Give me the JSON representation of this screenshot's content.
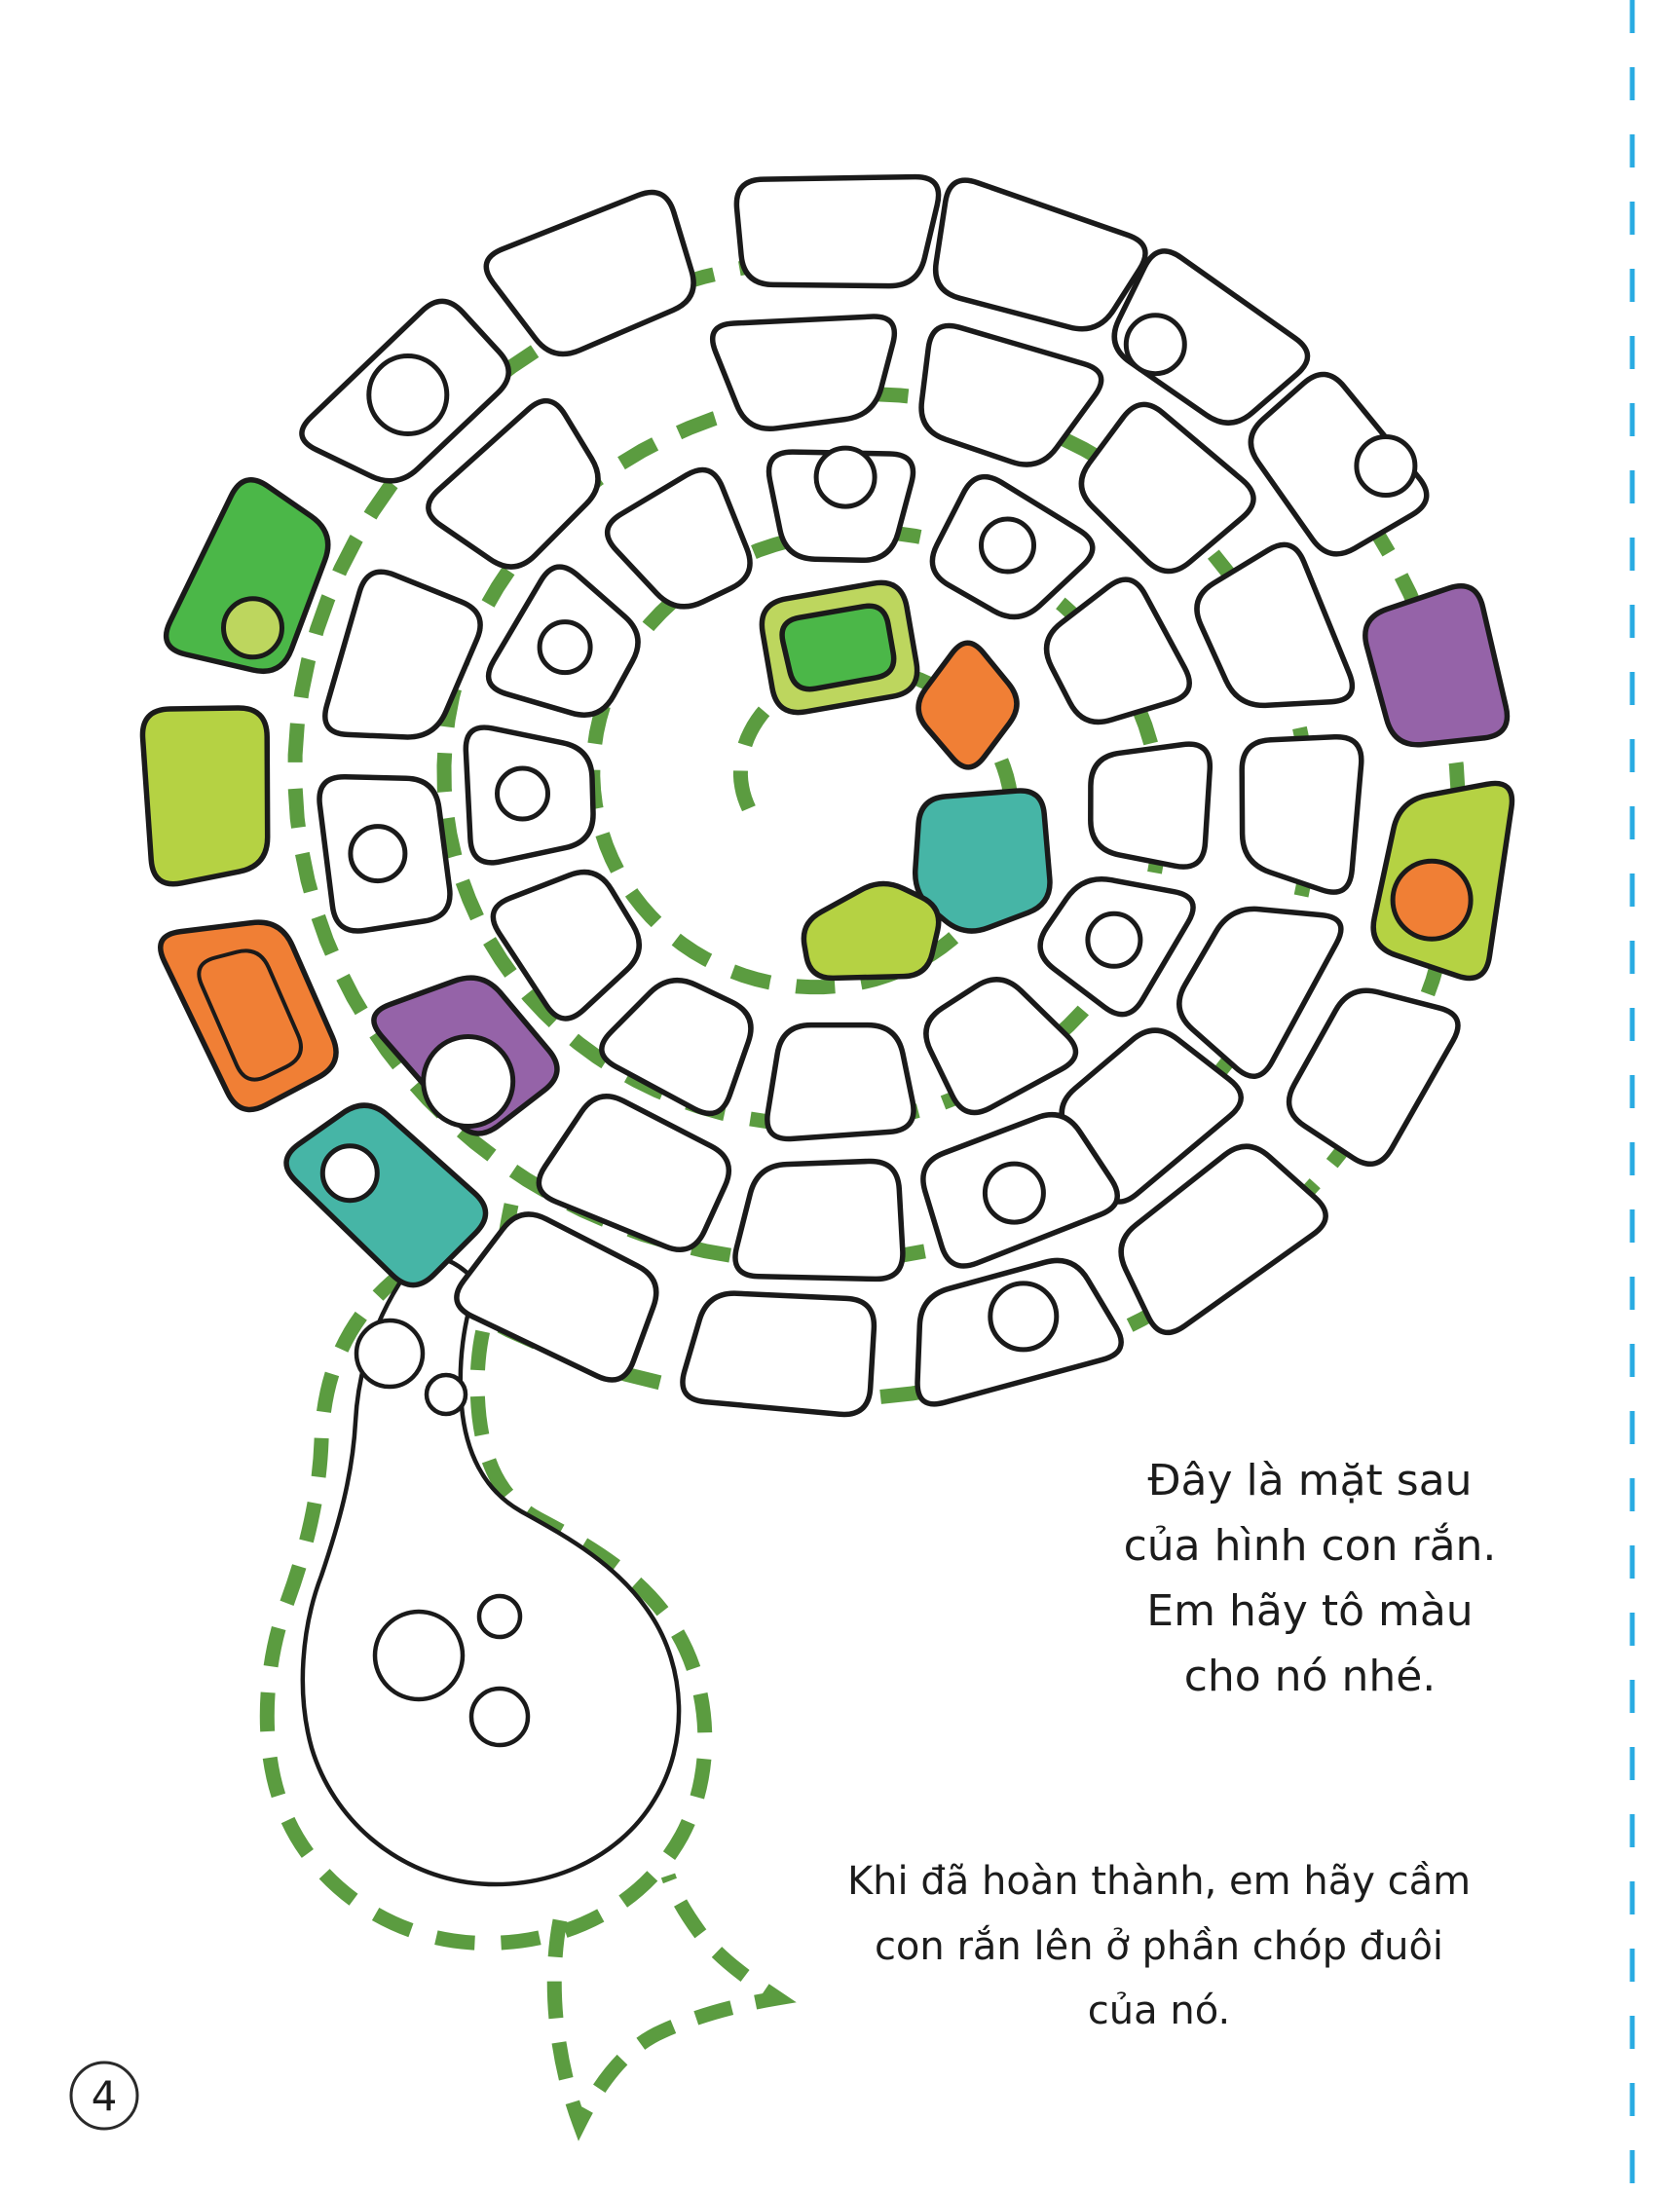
{
  "page": {
    "number": "4"
  },
  "instructions": {
    "block1": {
      "lines": [
        "Đây là mặt sau",
        "của hình con rắn.",
        "Em hãy tô màu",
        "cho nó nhé."
      ]
    },
    "block2": {
      "lines": [
        "Khi đã hoàn thành, em hãy cầm",
        "con rắn lên ở phần chóp đuôi",
        "của nó."
      ]
    }
  },
  "figure": {
    "description": "spiral snake back-side outline for coloring, dashed green cut lines, forked tail at bottom, spotted head bulb",
    "colors": {
      "white": "#ffffff",
      "green": "#4bb748",
      "lime": "#b5d243",
      "lime_light": "#bdd65e",
      "orange": "#f07f35",
      "teal": "#46b5a6",
      "purple": "#9563a8",
      "dash": "#5b9c40",
      "cyan": "#29abe2",
      "outline": "#1a1a1a"
    },
    "rings": {
      "1": {
        "r": [
          250,
          370
        ],
        "span": 23
      },
      "2": {
        "r": [
          396,
          516
        ],
        "span": 20
      },
      "3": {
        "r": [
          542,
          662
        ],
        "span": 17
      }
    },
    "scales": [
      {
        "ring": 3,
        "angle": 270,
        "color": "white"
      },
      {
        "ring": 3,
        "angle": 288,
        "color": "white"
      },
      {
        "ring": 3,
        "angle": 306,
        "color": "white",
        "spot": {
          "r": 30,
          "dr": -35,
          "da": -3
        }
      },
      {
        "ring": 3,
        "angle": 325,
        "color": "white",
        "spot": {
          "r": 30,
          "dr": 35,
          "da": 2
        }
      },
      {
        "ring": 3,
        "angle": 347,
        "color": "purple"
      },
      {
        "ring": 3,
        "angle": 8,
        "color": "lime",
        "spot": {
          "color": "orange",
          "r": 40,
          "dr": -12,
          "da": 3
        }
      },
      {
        "ring": 3,
        "angle": 30,
        "color": "white"
      },
      {
        "ring": 3,
        "angle": 52,
        "color": "white"
      },
      {
        "ring": 3,
        "angle": 74,
        "color": "white",
        "spot": {
          "r": 34,
          "dr": -20,
          "da": -2
        }
      },
      {
        "ring": 3,
        "angle": 96,
        "color": "white"
      },
      {
        "ring": 3,
        "angle": 118,
        "color": "white"
      },
      {
        "ring": 3,
        "angle": 137,
        "color": "teal",
        "dr": 18,
        "spot": {
          "r": 28,
          "dr": 5,
          "da": 3
        }
      },
      {
        "ring": 3,
        "angle": 158,
        "color": "orange",
        "dr": 22,
        "double": true
      },
      {
        "ring": 3,
        "angle": 180,
        "color": "lime",
        "dr": 22
      },
      {
        "ring": 3,
        "angle": 202,
        "color": "green",
        "dr": 18,
        "spot": {
          "color": "lime_light",
          "r": 30,
          "dr": -20,
          "da": -5
        }
      },
      {
        "ring": 3,
        "angle": 225,
        "color": "white",
        "spot": {
          "r": 40,
          "dr": -5,
          "da": 0
        }
      },
      {
        "ring": 3,
        "angle": 247,
        "color": "white"
      },
      {
        "ring": 2,
        "angle": 266,
        "color": "white"
      },
      {
        "ring": 2,
        "angle": 290,
        "color": "white"
      },
      {
        "ring": 2,
        "angle": 314,
        "color": "white"
      },
      {
        "ring": 2,
        "angle": 338,
        "color": "white"
      },
      {
        "ring": 2,
        "angle": 2,
        "color": "white"
      },
      {
        "ring": 2,
        "angle": 26,
        "color": "white"
      },
      {
        "ring": 2,
        "angle": 48,
        "color": "white"
      },
      {
        "ring": 2,
        "angle": 68,
        "color": "white",
        "spot": {
          "r": 30,
          "dr": 0,
          "da": 0
        }
      },
      {
        "ring": 2,
        "angle": 92,
        "color": "white"
      },
      {
        "ring": 2,
        "angle": 116,
        "color": "white"
      },
      {
        "ring": 2,
        "angle": 143,
        "color": "purple",
        "spot": {
          "r": 46,
          "dr": 18,
          "da": -3
        }
      },
      {
        "ring": 2,
        "angle": 172,
        "color": "white",
        "spot": {
          "r": 28,
          "dr": 0,
          "da": 0
        }
      },
      {
        "ring": 2,
        "angle": 198,
        "color": "white"
      },
      {
        "ring": 2,
        "angle": 225,
        "color": "white"
      },
      {
        "ring": 1,
        "angle": 270,
        "color": "white",
        "spot": {
          "r": 30,
          "dr": 25,
          "da": 1
        }
      },
      {
        "ring": 1,
        "angle": 302,
        "color": "white",
        "spot": {
          "r": 27,
          "dr": 0,
          "da": 0
        }
      },
      {
        "ring": 1,
        "angle": 332,
        "color": "white"
      },
      {
        "ring": 1,
        "angle": 2,
        "color": "white"
      },
      {
        "ring": 1,
        "angle": 30,
        "color": "white",
        "spot": {
          "r": 27,
          "dr": 0,
          "da": 0
        }
      },
      {
        "ring": 1,
        "angle": 60,
        "color": "white"
      },
      {
        "ring": 1,
        "angle": 90,
        "color": "white"
      },
      {
        "ring": 1,
        "angle": 120,
        "color": "white"
      },
      {
        "ring": 1,
        "angle": 150,
        "color": "white"
      },
      {
        "ring": 1,
        "angle": 180,
        "color": "white",
        "spot": {
          "r": 26,
          "dr": 0,
          "da": 0
        }
      },
      {
        "ring": 1,
        "angle": 210,
        "color": "white",
        "spot": {
          "r": 26,
          "dr": 0,
          "da": 0
        }
      },
      {
        "ring": 1,
        "angle": 240,
        "color": "white"
      }
    ],
    "center_pieces": [
      {
        "name": "tail-tip-border",
        "color": "lime_light",
        "cr": 30,
        "points": [
          [
            778,
            620
          ],
          [
            926,
            594
          ],
          [
            946,
            710
          ],
          [
            798,
            736
          ]
        ]
      },
      {
        "name": "tail-tip",
        "color": "green",
        "cr": 22,
        "points": [
          [
            799,
            638
          ],
          [
            908,
            619
          ],
          [
            921,
            692
          ],
          [
            816,
            711
          ]
        ]
      },
      {
        "name": "center-orange",
        "color": "orange",
        "cr": 26,
        "points": [
          [
            993,
            650
          ],
          [
            1052,
            722
          ],
          [
            995,
            798
          ],
          [
            935,
            728
          ]
        ]
      },
      {
        "name": "center-teal",
        "color": "teal",
        "cr": 26,
        "points": [
          [
            945,
            820
          ],
          [
            1070,
            810
          ],
          [
            1080,
            928
          ],
          [
            990,
            962
          ],
          [
            938,
            918
          ]
        ]
      },
      {
        "name": "center-lime",
        "color": "lime",
        "cr": 24,
        "points": [
          [
            822,
            948
          ],
          [
            906,
            902
          ],
          [
            968,
            932
          ],
          [
            952,
            1002
          ],
          [
            832,
            1005
          ]
        ]
      }
    ],
    "head_spots": [
      [
        400,
        1390,
        34
      ],
      [
        458,
        1432,
        20
      ],
      [
        430,
        1700,
        45
      ],
      [
        513,
        1660,
        21
      ],
      [
        513,
        1763,
        29
      ]
    ]
  }
}
